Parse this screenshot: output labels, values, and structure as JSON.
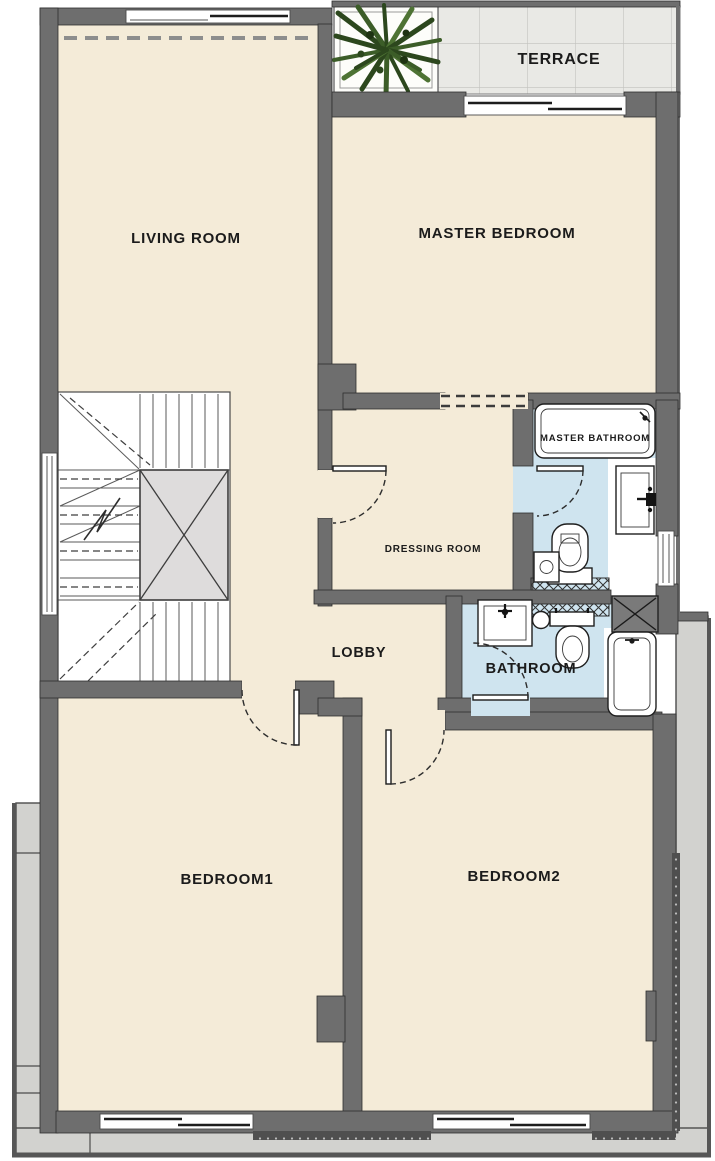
{
  "rooms": {
    "terrace": "TERRACE",
    "living_room": "LIVING ROOM",
    "master_bedroom": "MASTER BEDROOM",
    "master_bathroom": "MASTER BATHROOM",
    "dressing_room": "DRESSING ROOM",
    "lobby": "LOBBY",
    "bathroom": "BATHROOM",
    "bedroom1": "BEDROOM1",
    "bedroom2": "BEDROOM2"
  },
  "colors": {
    "wall": "#6e6e6e",
    "wall_edge": "#2f2f2f",
    "floor": "#f4ebd8",
    "bath_floor": "#cfe4ef",
    "terrace_tile": "#e9e9e5",
    "balcony": "#d2d2cf",
    "void_fill": "#dedcdc",
    "label_text": "#1b1b1b",
    "plant_green": "#3c5d28"
  },
  "fixtures": [
    "bathtub-master",
    "washbasin-master",
    "toilet-master",
    "floor-drain-master",
    "shower-hatch-master",
    "washbasin",
    "toilet",
    "floor-drain",
    "shower-hatch",
    "bathtub",
    "duct-shaft",
    "staircase",
    "stair-void",
    "potted-plant",
    "door-swing-dressing",
    "door-swing-master-bathroom",
    "door-swing-bathroom",
    "door-swing-bedroom1",
    "door-swing-bedroom2"
  ]
}
